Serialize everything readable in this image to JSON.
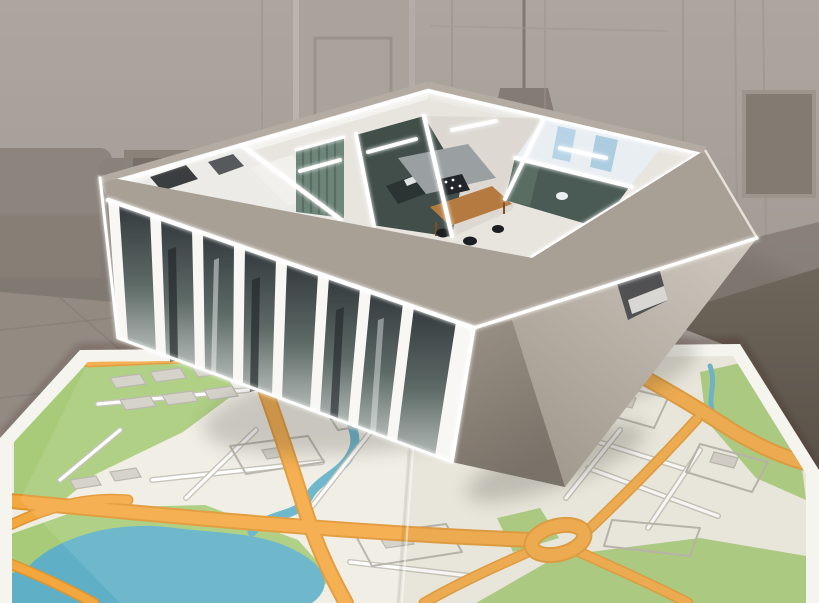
{
  "scene": {
    "type": "3d-render",
    "description": "Cutaway 3D model of an apartment floor plan with a glowing glass facade, hovering above a folded paper city map, in front of a faded living-room photo backdrop"
  },
  "backdrop": {
    "name": "faded living room",
    "colors": {
      "wall": "#a9a29b",
      "wall_dark": "#948c84",
      "sofa": "#7d746b",
      "floor": "#8b8279",
      "grout": "#7c746c",
      "corner_shadow": "#5f574e",
      "panel_line": "#968e85",
      "door": "#a8a099",
      "picture": "#776f66",
      "lamp": "#756c63"
    }
  },
  "model": {
    "name": "apartment floor plan model",
    "rooms": [
      "wardrobe-hall",
      "bedroom",
      "living-room",
      "kitchen-dining",
      "bathroom",
      "study"
    ],
    "colors": {
      "wall_top": "#a89f95",
      "facade_light": "#d0c9bf",
      "facade_dark": "#978e83",
      "underside": "#847b71",
      "window_frame": "#f8f7f4",
      "glass_top": "#343a3e",
      "glass_bottom": "#b2b9b6",
      "interior_floor": "#e8e5df",
      "inner_wall": "#f3f2ef",
      "accent_teal": "#6e8579",
      "accent_teal_dark": "#586e63",
      "dark_room": "#414e4a",
      "desk_dark": "#2b3433",
      "counter": "#9aa0a2",
      "hob": "#22262a",
      "table_wood": "#b57a40",
      "chair": "#1c1f22",
      "bath_tile": "#e9eef3",
      "bath_glass": "#aecfe3",
      "study_dark": "#4a5a54",
      "facade_slot": "#45464a",
      "glow": "#ffffff"
    }
  },
  "map": {
    "name": "folded city map",
    "features": [
      "parks",
      "lake",
      "river",
      "orange-roads",
      "roundabout",
      "white-streets",
      "building-blocks",
      "fold-crease"
    ],
    "colors": {
      "paper": "#f6f4ee",
      "base": "#efece2",
      "road": "#f3a73f",
      "road_casing": "#e0942c",
      "street": "#ffffff",
      "street_casing": "#c2bfb4",
      "park": "#a7cb79",
      "water": "#5fb0c7",
      "building": "#d2cfc6",
      "building_outline": "#b3b0a6"
    },
    "shadow_color": "#2e2a26"
  }
}
